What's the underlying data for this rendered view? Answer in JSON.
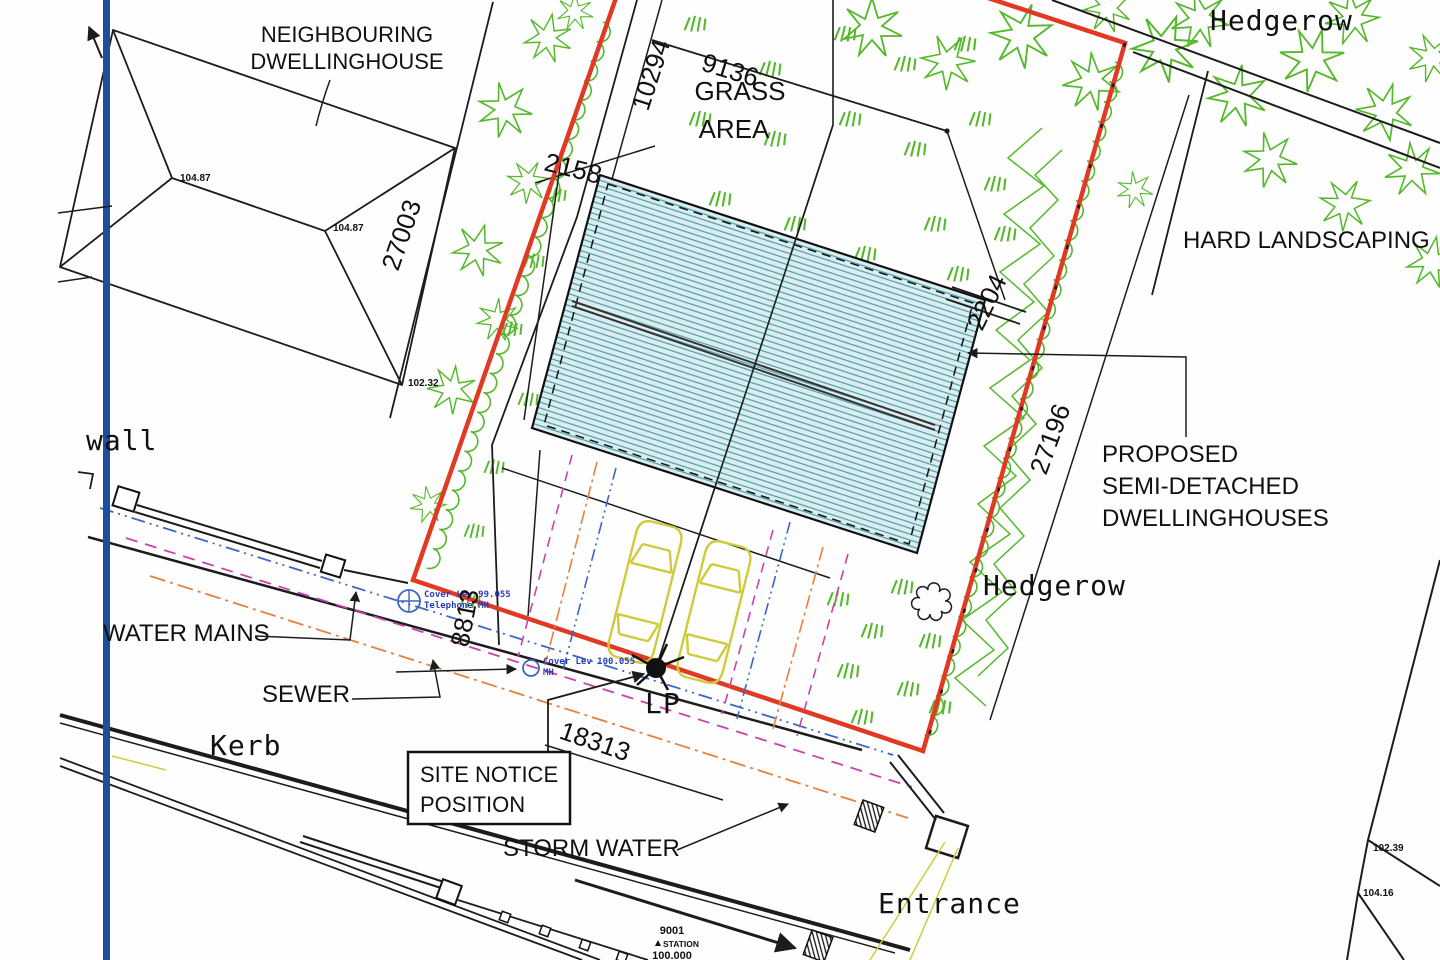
{
  "labels": {
    "neighbouring_line1": "NEIGHBOURING",
    "neighbouring_line2": "DWELLINGHOUSE",
    "grass_line1": "GRASS",
    "grass_line2": "AREA",
    "hard_landscaping": "HARD LANDSCAPING",
    "hedgerow_top": "Hedgerow",
    "hedgerow_mid": "Hedgerow",
    "proposed_line1": "PROPOSED",
    "proposed_line2": "SEMI-DETACHED",
    "proposed_line3": "DWELLINGHOUSES",
    "water_mains": "WATER MAINS",
    "sewer": "SEWER",
    "kerb": "Kerb",
    "wall": "wall",
    "site_notice_line1": "SITE NOTICE",
    "site_notice_line2": "POSITION",
    "storm_water": "STORM WATER",
    "entrance": "Entrance",
    "lp": "LP"
  },
  "dimensions": {
    "d10294": "10294",
    "d9136": "9136",
    "d2158": "2158",
    "d27003": "27003",
    "d2204": "2204",
    "d27196": "27196",
    "d8813": "8813",
    "d18313": "18313"
  },
  "spot_levels": {
    "ridge1": "104.87",
    "ridge2": "104.87",
    "eaves": "102.32",
    "right_upper": "102.39",
    "right_lower": "104.16"
  },
  "manholes": {
    "mh1_line1": "Cover Lev 99.055",
    "mh1_line2": "Telephone MH",
    "mh2_line1": "Cover Lev 100.055",
    "mh2_line2": "MH"
  },
  "station": {
    "id": "9001",
    "label": "STATION",
    "level": "100.000"
  },
  "colors": {
    "boundary_red": "#e03a24",
    "datum_blue": "#1d4e9e",
    "vegetation_green": "#55b82a",
    "roof_fill": "#daedf0",
    "roof_hatch": "#4b9aa3",
    "car_yellow": "#cfcb3d",
    "service_magenta": "#cb42ad",
    "service_orange": "#e5813f",
    "water_blue": "#3b66c4",
    "mh_text_blue": "#2b3db5",
    "line_black": "#1c1c1c"
  }
}
